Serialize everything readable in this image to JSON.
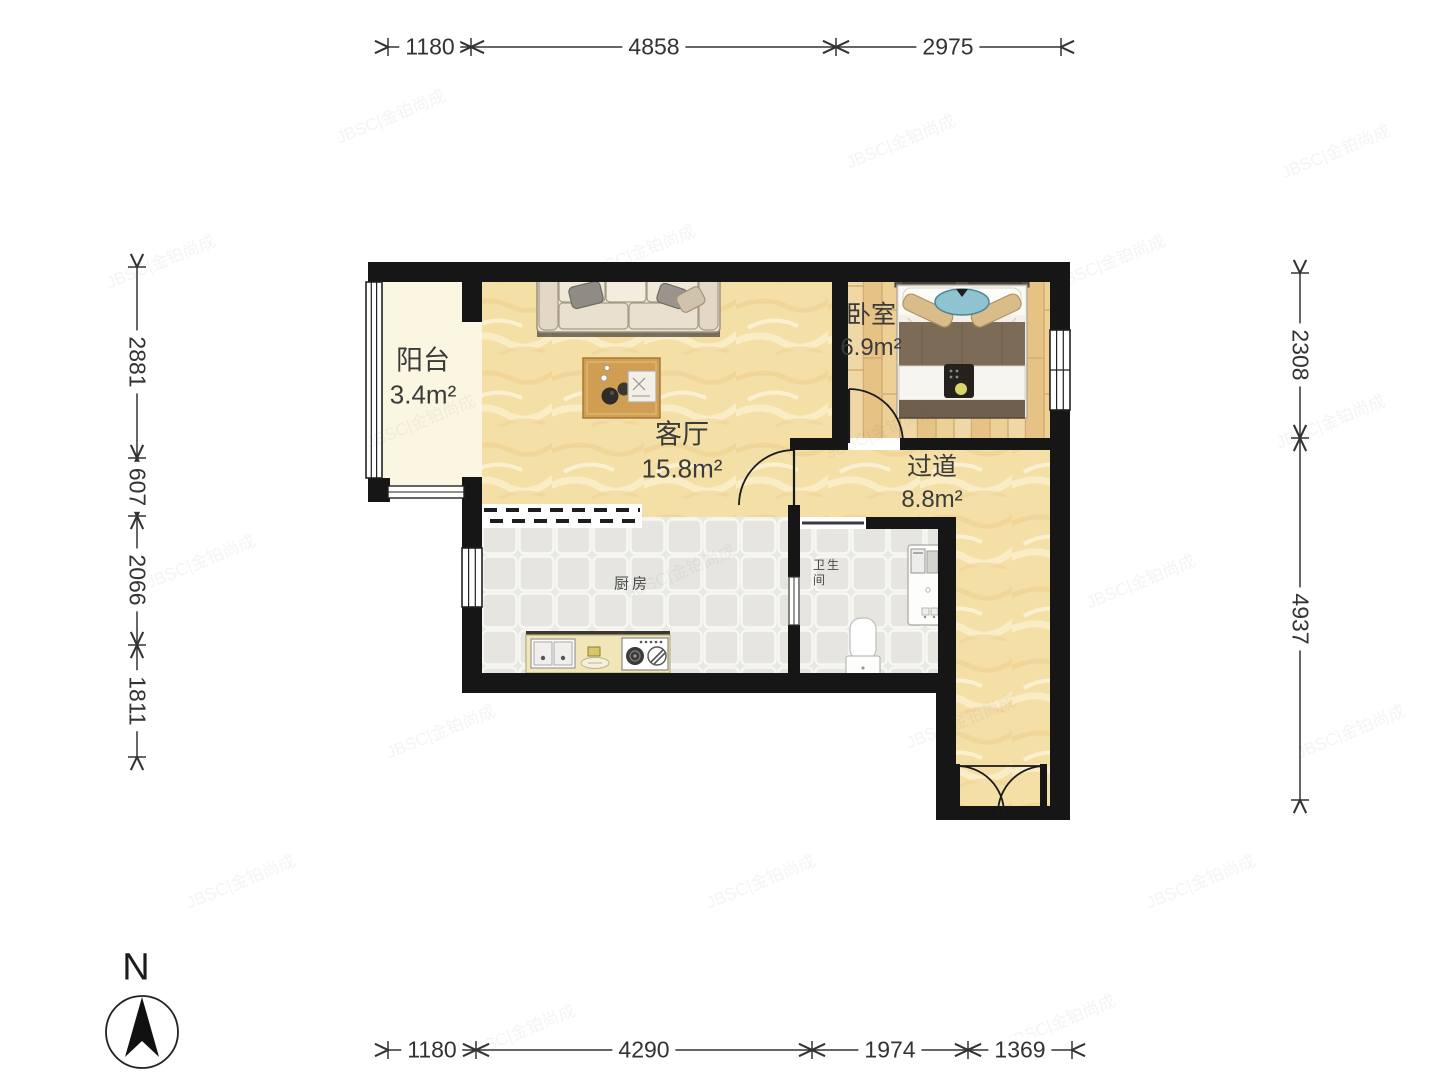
{
  "rooms": [
    {
      "name": "阳台",
      "area": "3.4m²"
    },
    {
      "name": "客厅",
      "area": "15.8m²"
    },
    {
      "name": "卧室",
      "area": "6.9m²"
    },
    {
      "name": "过道",
      "area": "8.8m²"
    },
    {
      "name": "厨房",
      "area": ""
    },
    {
      "name": "卫生间",
      "area": ""
    }
  ],
  "dimensions_mm": {
    "top": [
      "1180",
      "4858",
      "2975"
    ],
    "bottom": [
      "1180",
      "4290",
      "1974",
      "1369"
    ],
    "left": [
      "2881",
      "607",
      "2066",
      "1811"
    ],
    "right": [
      "2308",
      "4937"
    ]
  },
  "compass": {
    "label": "N"
  },
  "watermark": {
    "text": "JBSC|金铂尚成"
  },
  "colors": {
    "wall": "#161616",
    "marble_floor": "#f4e0a6",
    "wood_floor": "#ecd096",
    "tile_floor": "#e9e8e3",
    "balcony_floor": "#faf6e2",
    "dimension_text": "#333333"
  }
}
